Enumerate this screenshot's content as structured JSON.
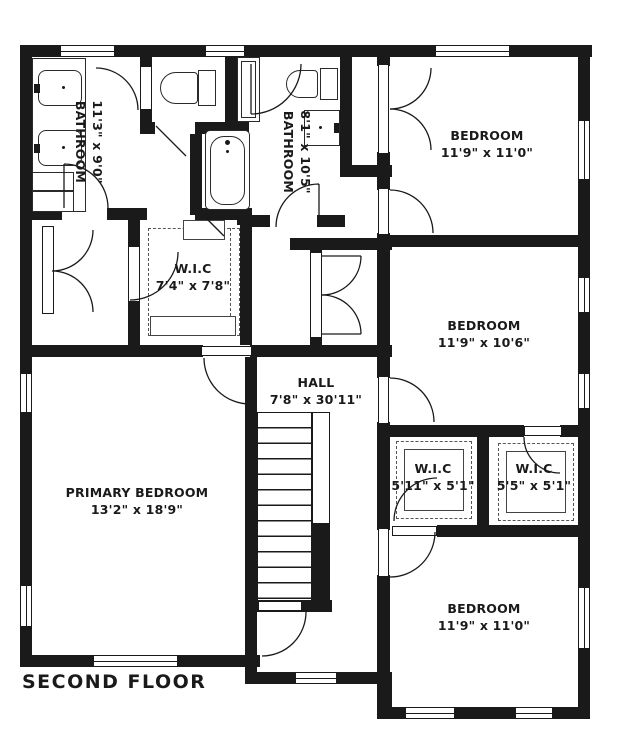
{
  "title": "SECOND FLOOR",
  "rooms": {
    "bathroom1": {
      "name": "BATHROOM",
      "dims": "11'3\" x 9'0\""
    },
    "bathroom2": {
      "name": "BATHROOM",
      "dims": "8'1\" x 10'5\""
    },
    "bedroom1": {
      "name": "BEDROOM",
      "dims": "11'9\" x 11'0\""
    },
    "bedroom2": {
      "name": "BEDROOM",
      "dims": "11'9\" x 10'6\""
    },
    "bedroom3": {
      "name": "BEDROOM",
      "dims": "11'9\" x 11'0\""
    },
    "primary": {
      "name": "PRIMARY BEDROOM",
      "dims": "13'2\" x 18'9\""
    },
    "wic1": {
      "name": "W.I.C",
      "dims": "7'4\" x 7'8\""
    },
    "wic2": {
      "name": "W.I.C",
      "dims": "5'11\" x 5'1\""
    },
    "wic3": {
      "name": "W.I.C",
      "dims": "5'5\" x 5'1\""
    },
    "hall": {
      "name": "HALL",
      "dims": "7'8\" x 30'11\""
    }
  },
  "fixtures": [
    "bathtub",
    "toilet",
    "toilet",
    "sink",
    "sink",
    "sink",
    "shower",
    "vanity",
    "stairs"
  ],
  "colors": {
    "wall": "#1a1a1a",
    "background": "#ffffff"
  }
}
